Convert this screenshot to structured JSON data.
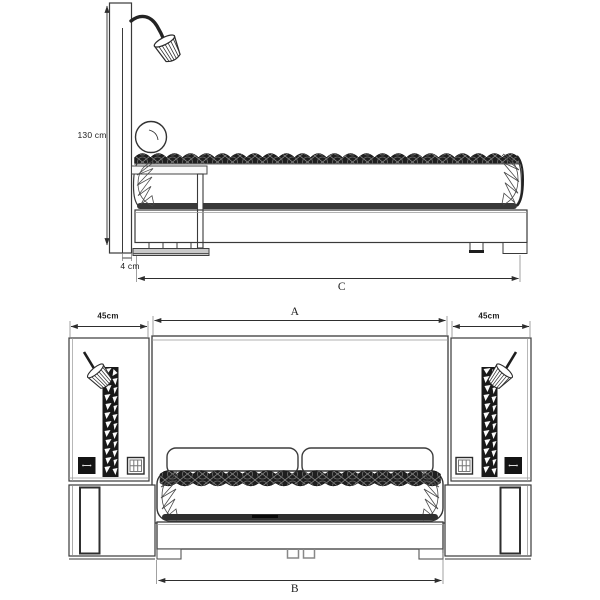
{
  "drawing": {
    "background": "#ffffff",
    "ink_color": "#3a3a3a",
    "dark_fill": "#1f1f1f",
    "side_view": {
      "labels": {
        "headboard_height": "130 cm",
        "panel_thickness": "4 cm",
        "bed_length": "C"
      }
    },
    "front_view": {
      "labels": {
        "left_panel_width": "45cm",
        "headboard_width": "A",
        "right_panel_width": "45cm",
        "bed_width": "B"
      }
    }
  }
}
